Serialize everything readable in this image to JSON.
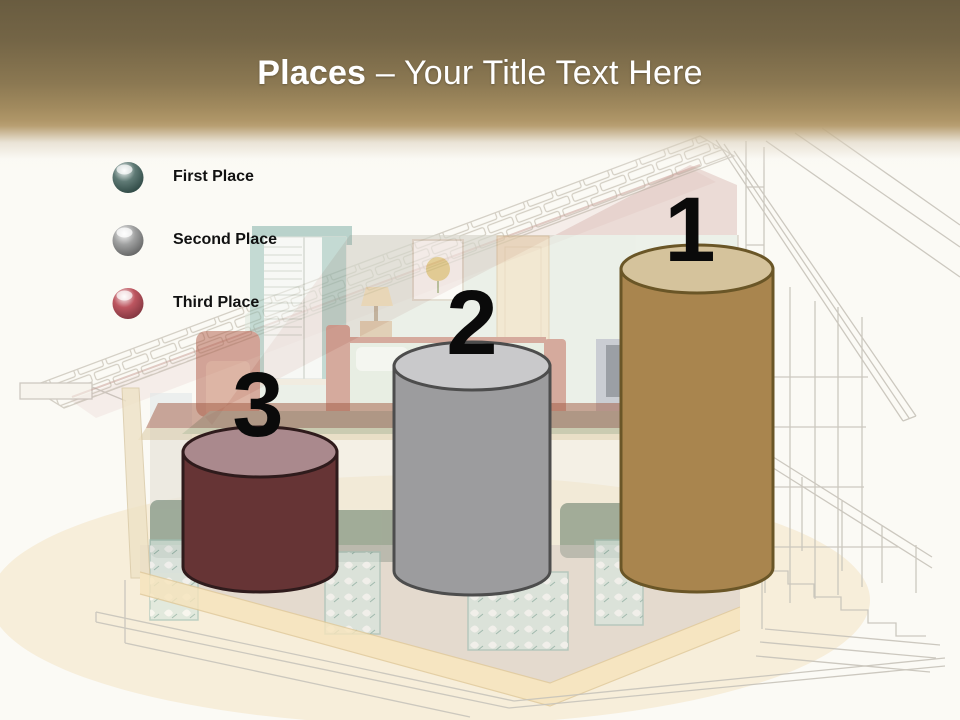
{
  "slide": {
    "header": {
      "title_bold": "Places",
      "title_regular": " – Your Title Text Here",
      "title_text_color": "#ffffff",
      "gradient_top_color": "#695c40",
      "gradient_gold_color": "#b89f72"
    },
    "legend": {
      "items": [
        {
          "label": "First Place",
          "sphere_color": "#5f7a75",
          "sphere_dark_color": "#2c4642"
        },
        {
          "label": "Second Place",
          "sphere_color": "#a0a1a1",
          "sphere_dark_color": "#606161"
        },
        {
          "label": "Third Place",
          "sphere_color": "#bd5660",
          "sphere_dark_color": "#7e343e"
        }
      ]
    },
    "podium": {
      "number_color": "#0a0a0a",
      "items": [
        {
          "rank": "3",
          "place": "Third Place",
          "body_color": "#663435",
          "top_color": "#aa898d",
          "outline_color": "#2f1b1c"
        },
        {
          "rank": "2",
          "place": "Second Place",
          "body_color": "#9c9c9e",
          "top_color": "#c9c9cb",
          "outline_color": "#4d4d4d"
        },
        {
          "rank": "1",
          "place": "First Place",
          "body_color": "#a9854e",
          "top_color": "#d5c39c",
          "outline_color": "#6a5627"
        }
      ]
    }
  }
}
